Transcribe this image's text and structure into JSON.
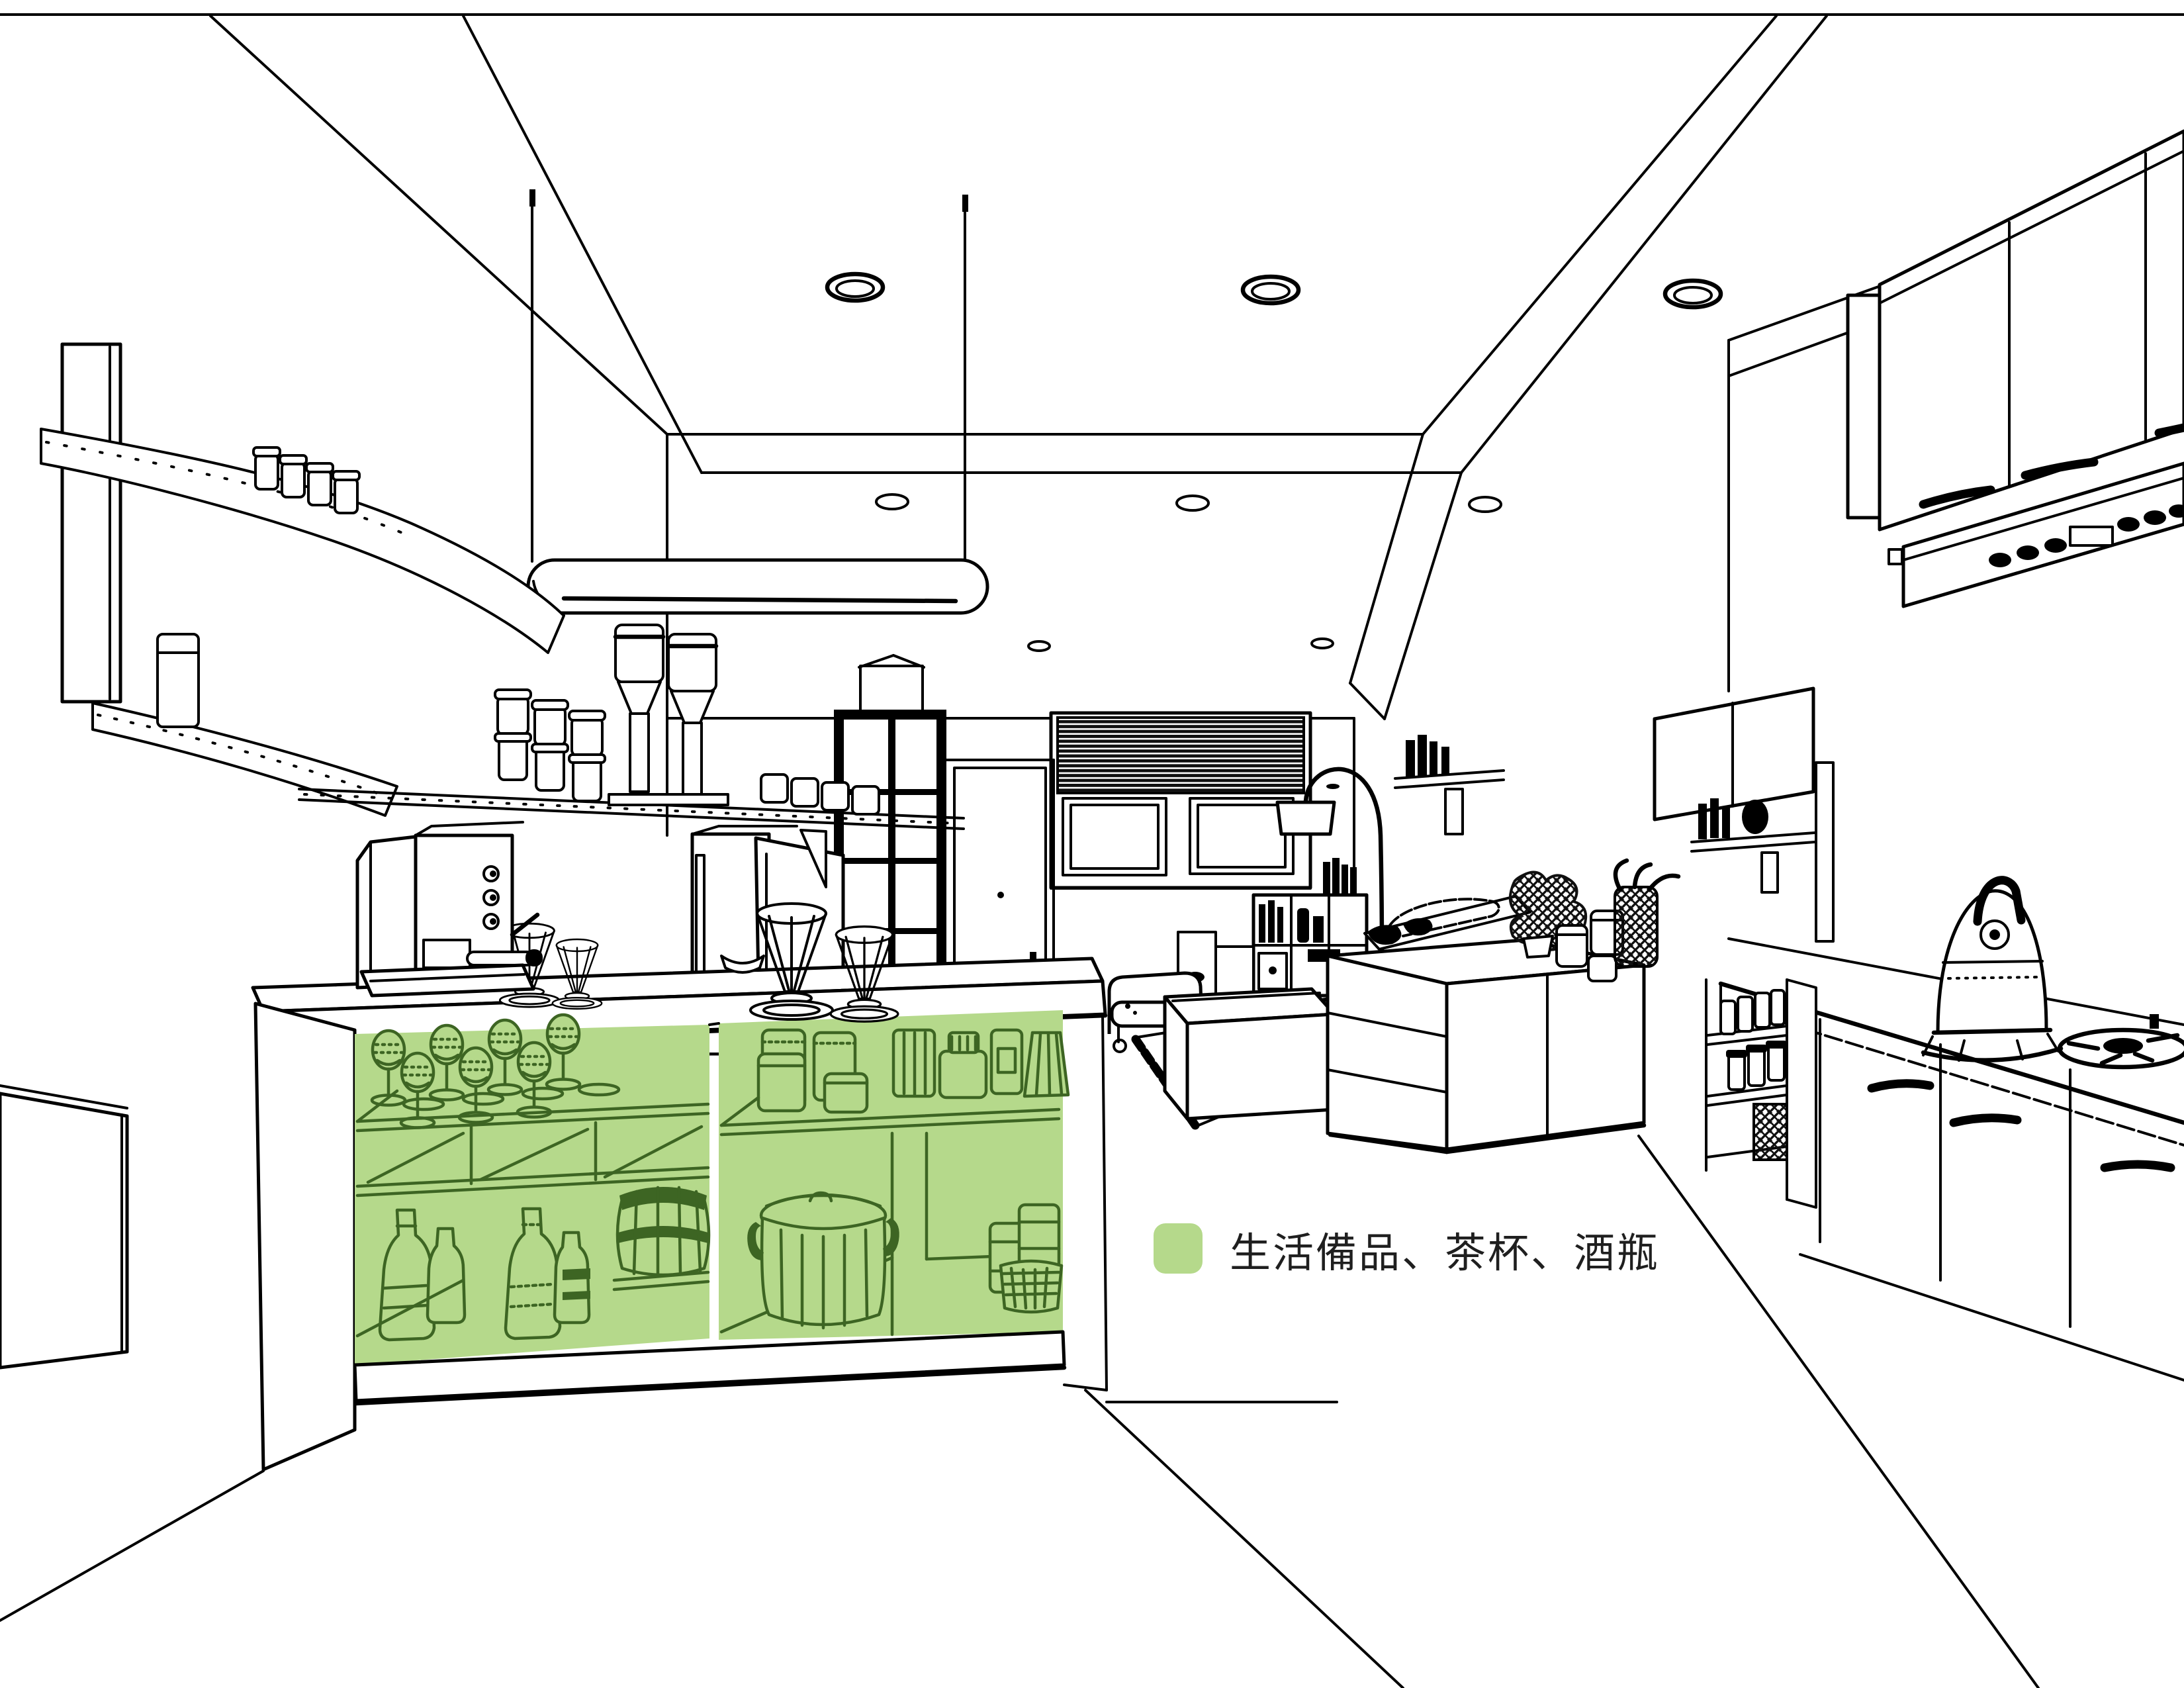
{
  "colors": {
    "background": "#ffffff",
    "line": "#000000",
    "highlight_fill": "#b5d98b",
    "highlight_line": "#3d6523",
    "legend_text": "#1f1f1f"
  },
  "legend": {
    "swatch_color": "#b5d98b",
    "label": "生活備品、茶杯、酒瓶"
  },
  "scene": {
    "type": "interior-perspective-line-drawing",
    "highlighted_storage": {
      "location": "kitchen-island-open-shelves",
      "items": [
        "wine-glasses",
        "glass-jars",
        "wine-bottles",
        "small-barrel",
        "lidded-pot",
        "stacked-cups"
      ]
    }
  }
}
